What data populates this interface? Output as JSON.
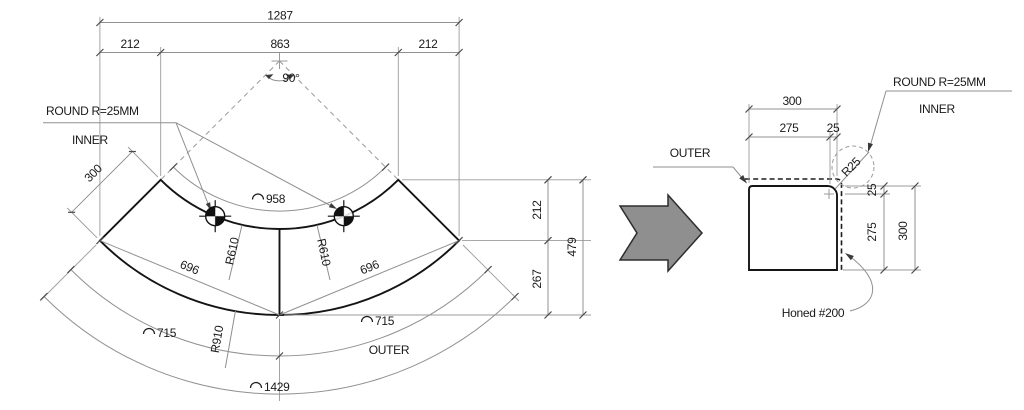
{
  "main": {
    "dim_total_width": "1287",
    "dim_left_offset": "212",
    "dim_center_width": "863",
    "dim_right_offset": "212",
    "dim_angle": "90°",
    "label_round": "ROUND R=25MM",
    "label_inner": "INNER",
    "dim_depth": "300",
    "dim_inner_arc": "958",
    "dim_inner_radius_left": "R610",
    "dim_inner_radius_right": "R610",
    "dim_chord_left": "696",
    "dim_chord_right": "696",
    "dim_right_upper": "212",
    "dim_right_lower": "267",
    "dim_right_total": "479",
    "dim_outer_arc_left": "715",
    "dim_outer_arc_right": "715",
    "dim_outer_radius": "R910",
    "label_outer": "OUTER",
    "dim_outer_arc_total": "1429"
  },
  "detail": {
    "label_round": "ROUND R=25MM",
    "label_inner": "INNER",
    "label_outer": "OUTER",
    "dim_top_total": "300",
    "dim_top_left": "275",
    "dim_top_right": "25",
    "dim_corner_radius": "R25",
    "dim_right_upper": "25",
    "dim_right_lower": "275",
    "dim_right_total": "300",
    "label_finish": "Honed #200"
  }
}
